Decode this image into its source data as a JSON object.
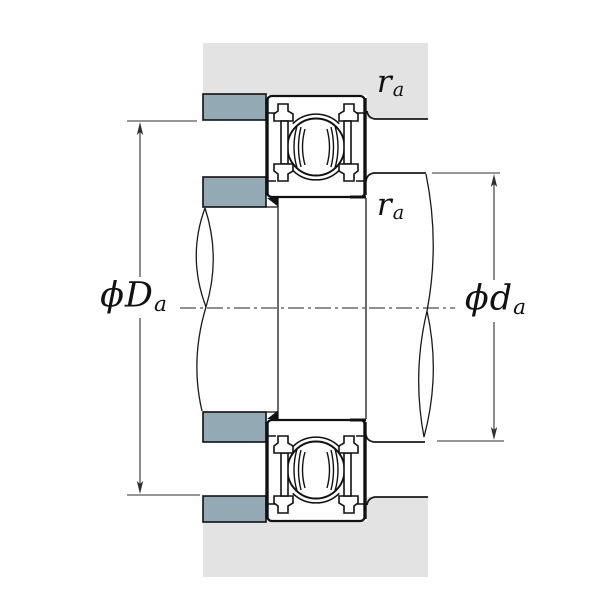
{
  "figure": {
    "type": "bearing-mounting-cross-section-diagram"
  },
  "labels": {
    "housing_abutment_diameter": {
      "phi": "ϕ",
      "main": "D",
      "sub": "a"
    },
    "shaft_abutment_diameter": {
      "phi": "ϕ",
      "main": "d",
      "sub": "a"
    },
    "fillet_radius_housing": {
      "main": "r",
      "sub": "a"
    },
    "fillet_radius_shaft": {
      "main": "r",
      "sub": "a"
    }
  },
  "colors": {
    "background": "#ffffff",
    "housing_fill": "#e3e3e3",
    "shoulder_fill": "#93a9b4",
    "outline": "#1a1a1a",
    "dimension_line": "#2f2f2f"
  }
}
